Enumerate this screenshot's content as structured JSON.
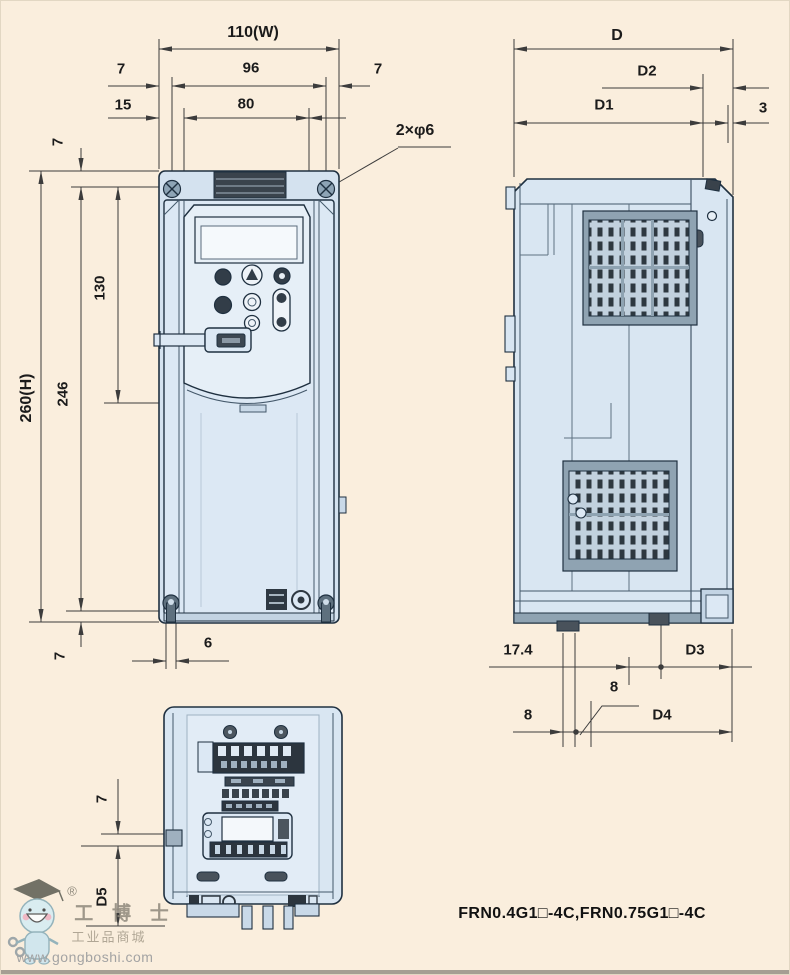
{
  "colors": {
    "background": "#faeedd",
    "body_fill": "#d9e6f2",
    "outline": "#1f3040",
    "vent_dark": "#2e3840",
    "dim_line": "#3c3c3c"
  },
  "front_view": {
    "title": "front-view-of-inverter",
    "dims": {
      "width_total": "110(W)",
      "margin_left_top": "7",
      "hole_span": "96",
      "margin_right_top": "7",
      "inset_left": "15",
      "keypad_span": "80",
      "mounting_holes_note": "2×φ6",
      "margin_top": "7",
      "height_total": "260(H)",
      "hole_pitch_height": "246",
      "keypad_height": "130",
      "margin_bottom": "7",
      "slot_width": "6"
    }
  },
  "side_view": {
    "title": "side-view-of-inverter",
    "dims": {
      "depth_total": "D",
      "depth_d2": "D2",
      "depth_d1": "D1",
      "back_clearance": "3",
      "bottom_17_4": "17.4",
      "bottom_d3": "D3",
      "bottom_8_upper": "8",
      "bottom_8_lower": "8",
      "bottom_d4": "D4"
    }
  },
  "bottom_view": {
    "title": "bottom-view-of-inverter",
    "dims": {
      "margin_7": "7",
      "depth_d5": "D5"
    }
  },
  "footer": {
    "models": "FRN0.4G1□-4C,FRN0.75G1□-4C"
  },
  "watermark": {
    "registered": "®",
    "brand": "工 博 士",
    "tagline": "工业品商城",
    "url": "www.gongboshi.com"
  }
}
